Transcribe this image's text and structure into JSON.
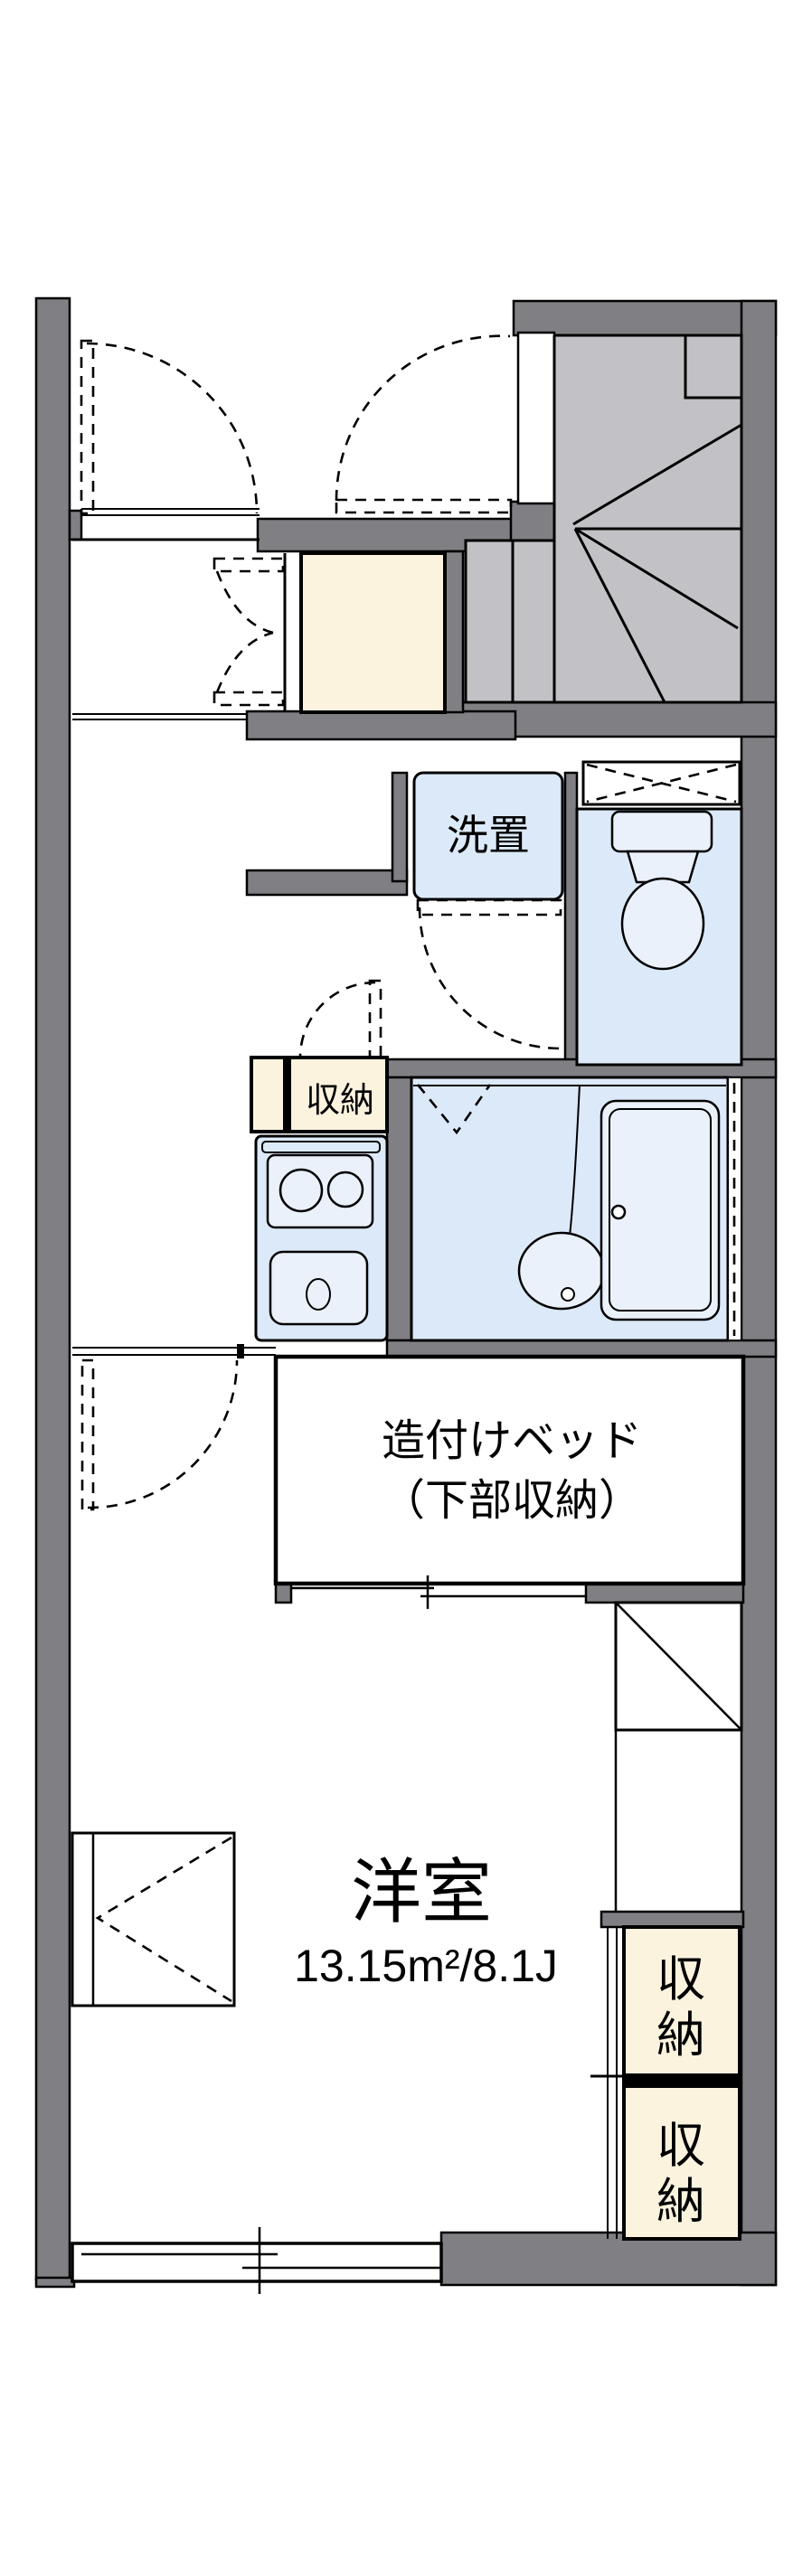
{
  "floorplan": {
    "labels": {
      "laundry": "洗置",
      "hall_storage": "収納",
      "bed_line1": "造付けベッド",
      "bed_line2": "（下部収納）",
      "room_name": "洋室",
      "room_size": "13.15m²/8.1J",
      "closet_upper": "収納",
      "closet_lower": "収納",
      "closet_upper_chars": [
        "収",
        "納"
      ],
      "closet_lower_chars": [
        "収",
        "納"
      ]
    },
    "colors": {
      "wall": "#7f7f84",
      "stair": "#c2c2c6",
      "water": "#dce9f8",
      "fixture": "#eaf1fb",
      "cream": "#fcf3de"
    }
  }
}
